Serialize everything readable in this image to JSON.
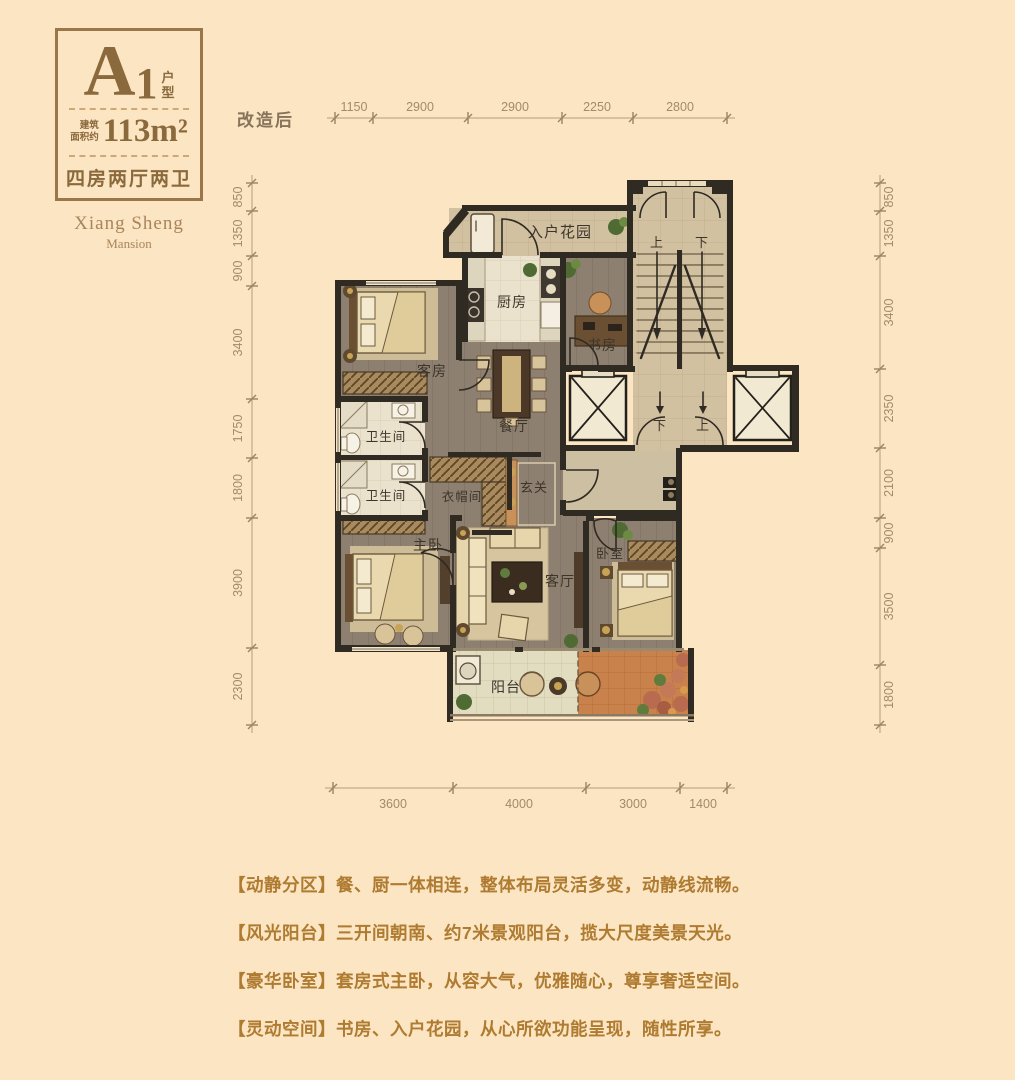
{
  "badge": {
    "letter": "A",
    "number": "1",
    "suffix_top": "户",
    "suffix_bottom": "型",
    "area_label_top": "建筑",
    "area_label_bottom": "面积约",
    "area": "113m²",
    "layout": "四房两厅两卫"
  },
  "brand": {
    "name": "Xiang Sheng",
    "sub": "Mansion"
  },
  "plan": {
    "state_label": "改造后",
    "rooms": {
      "entry_garden": "入户花园",
      "kitchen": "厨房",
      "study": "书房",
      "guest": "客房",
      "dining": "餐厅",
      "bath_upper": "卫生间",
      "bath_lower": "卫生间",
      "cloak": "衣帽间",
      "foyer": "玄关",
      "master": "主卧",
      "living": "客厅",
      "bedroom": "卧室",
      "balcony": "阳台"
    },
    "stairs": {
      "up": "上",
      "down": "下",
      "landing_down": "下",
      "landing_up": "上"
    },
    "dims": {
      "top": [
        "1150",
        "2900",
        "2900",
        "2250",
        "2800"
      ],
      "left": [
        "850",
        "1350",
        "900",
        "3400",
        "1750",
        "1800",
        "3900",
        "2300"
      ],
      "right": [
        "850",
        "1350",
        "3400",
        "2350",
        "2100",
        "900",
        "3500",
        "1800"
      ],
      "bottom": [
        "3600",
        "4000",
        "3000",
        "1400"
      ]
    }
  },
  "features": [
    "【动静分区】餐、厨一体相连，整体布局灵活多变，动静线流畅。",
    "【风光阳台】三开间朝南、约7米景观阳台，揽大尺度美景天光。",
    "【豪华卧室】套房式主卧，从容大气，优雅随心，尊享奢适空间。",
    "【灵动空间】书房、入户花园，从心所欲功能呈现，随性所享。"
  ],
  "colors": {
    "background": "#fce5c3",
    "accent": "#9a7748",
    "feature_text": "#ae7b31",
    "wall": "#2f2a22"
  }
}
